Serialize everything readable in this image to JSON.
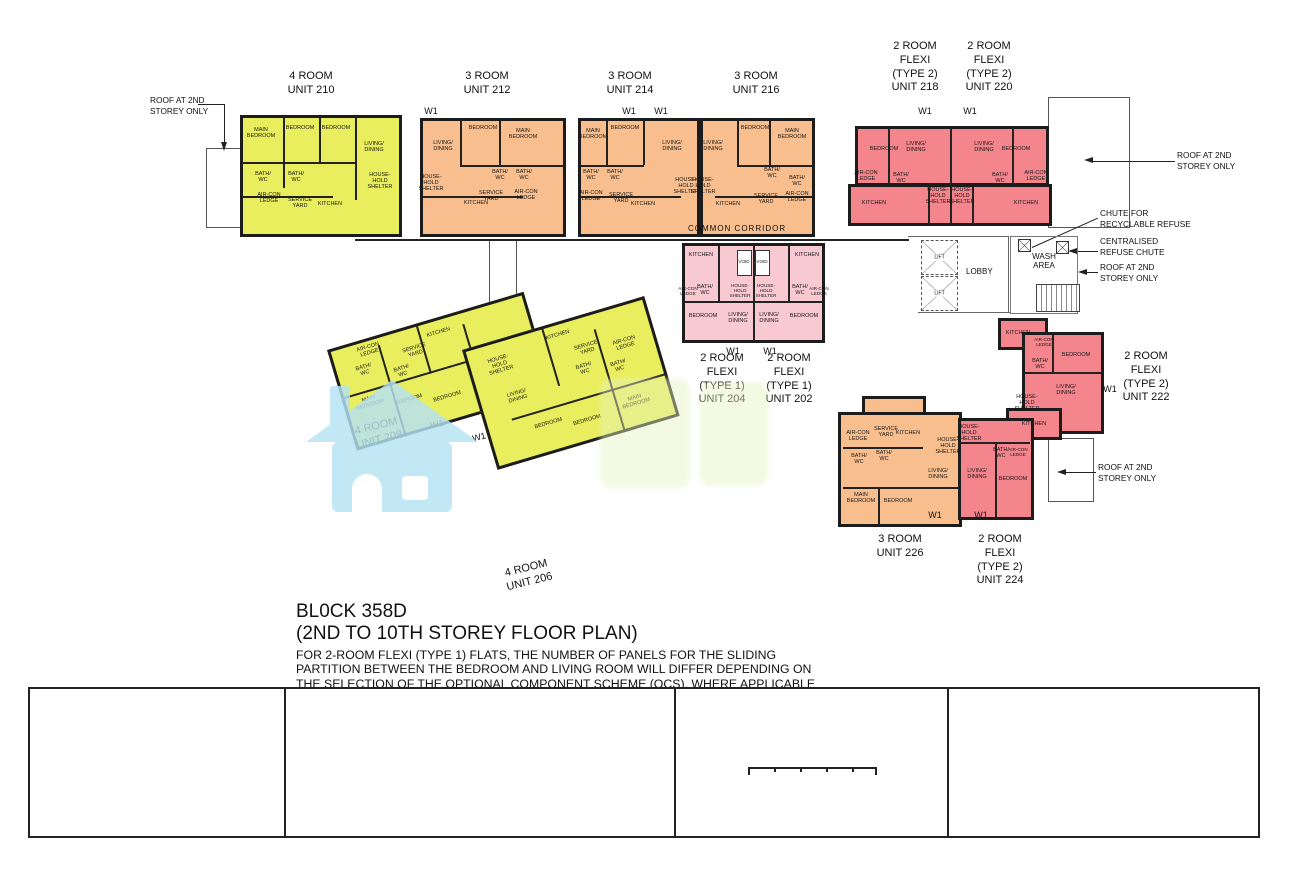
{
  "plan": {
    "w1": "W1",
    "areas": {
      "common_corridor": "COMMON  CORRIDOR",
      "lobby": "LOBBY",
      "wash_area": "WASH\nAREA",
      "lift": "LIFT"
    },
    "annotations": {
      "roof_2nd": "ROOF AT 2ND\nSTOREY ONLY",
      "chute_recyclable": "CHUTE FOR\nRECYCLABLE REFUSE",
      "centralised_chute": "CENTRALISED\nREFUSE CHUTE"
    },
    "units": {
      "u210": {
        "title": "4 ROOM\nUNIT 210",
        "rooms": [
          "MAIN\nBEDROOM",
          "BEDROOM",
          "BEDROOM",
          "LIVING/\nDINING",
          "BATH/\nWC",
          "BATH/\nWC",
          "AIR-CON\nLEDGE",
          "SERVICE\nYARD",
          "KITCHEN",
          "HOUSE-\nHOLD\nSHELTER"
        ]
      },
      "u212": {
        "title": "3 ROOM\nUNIT 212",
        "rooms": [
          "LIVING/\nDINING",
          "BEDROOM",
          "MAIN\nBEDROOM",
          "HOUSE-\nHOLD\nSHELTER",
          "BATH/\nWC",
          "BATH/\nWC",
          "SERVICE\nYARD",
          "AIR-CON\nLEDGE",
          "KITCHEN"
        ]
      },
      "u214": {
        "title": "3 ROOM\nUNIT 214",
        "rooms": [
          "MAIN\nBEDROOM",
          "BEDROOM",
          "LIVING/\nDINING",
          "BATH/\nWC",
          "BATH/\nWC",
          "AIR-CON\nLEDGE",
          "SERVICE\nYARD",
          "KITCHEN",
          "HOUSE-\nHOLD\nSHELTER"
        ]
      },
      "u216": {
        "title": "3 ROOM\nUNIT 216",
        "rooms": [
          "LIVING/\nDINING",
          "BEDROOM",
          "MAIN\nBEDROOM",
          "HOUSE-\nHOLD\nSHELTER",
          "BATH/\nWC",
          "BATH/\nWC",
          "SERVICE\nYARD",
          "AIR-CON\nLEDGE",
          "KITCHEN"
        ]
      },
      "u218": {
        "title": "2 ROOM\nFLEXI\n(TYPE 2)\nUNIT 218",
        "rooms": [
          "BEDROOM",
          "LIVING/\nDINING",
          "BATH/\nWC",
          "AIR-CON\nLEDGE",
          "HOUSE-\nHOLD\nSHELTER",
          "KITCHEN"
        ]
      },
      "u220": {
        "title": "2 ROOM\nFLEXI\n(TYPE 2)\nUNIT 220",
        "rooms": [
          "LIVING/\nDINING",
          "BEDROOM",
          "BATH/\nWC",
          "AIR-CON\nLEDGE",
          "HOUSE-\nHOLD\nSHELTER",
          "KITCHEN"
        ]
      },
      "u204": {
        "title": "2 ROOM\nFLEXI\n(TYPE 1)\nUNIT 204",
        "rooms": [
          "KITCHEN",
          "VOID",
          "BATH/\nWC",
          "AIR-CON\nLEDGE",
          "HOUSE-\nHOLD\nSHELTER",
          "BEDROOM",
          "LIVING/\nDINING"
        ]
      },
      "u202": {
        "title": "2 ROOM\nFLEXI\n(TYPE 1)\nUNIT 202",
        "rooms": [
          "KITCHEN",
          "VOID",
          "BATH/\nWC",
          "AIR-CON\nLEDGE",
          "HOUSE-\nHOLD\nSHELTER",
          "BEDROOM",
          "LIVING/\nDINING"
        ]
      },
      "u222": {
        "title": "2 ROOM\nFLEXI\n(TYPE 2)\nUNIT 222",
        "rooms": [
          "KITCHEN",
          "AIR-CON\nLEDGE",
          "BATH/\nWC",
          "BEDROOM",
          "LIVING/\nDINING",
          "HOUSE-\nHOLD\nSHELTER"
        ]
      },
      "u226": {
        "title": "3 ROOM\nUNIT 226",
        "rooms": [
          "AIR-CON\nLEDGE",
          "SERVICE\nYARD",
          "KITCHEN",
          "BATH/\nWC",
          "BATH/\nWC",
          "LIVING/\nDINING",
          "MAIN\nBEDROOM",
          "BEDROOM",
          "HOUSE-\nHOLD\nSHELTER"
        ]
      },
      "u224": {
        "title": "2 ROOM\nFLEXI\n(TYPE 2)\nUNIT 224",
        "rooms": [
          "KITCHEN",
          "HOUSE-\nHOLD\nSHELTER",
          "BATH/\nWC",
          "AIR-CON\nLEDGE",
          "LIVING/\nDINING",
          "BEDROOM"
        ]
      },
      "u208": {
        "title": "4 ROOM\nUNIT 208",
        "rooms": [
          "AIR-CON\nLEDGE",
          "BATH/\nWC",
          "BATH/\nWC",
          "KITCHEN",
          "SERVICE\nYARD",
          "MAIN\nBEDROOM",
          "BEDROOM",
          "BEDROOM",
          "LIVING/\nDINING"
        ]
      },
      "u206": {
        "title": "4 ROOM\nUNIT 206",
        "rooms": [
          "KITCHEN",
          "HOUSE-\nHOLD\nSHELTER",
          "SERVICE\nYARD",
          "BATH/\nWC",
          "BATH/\nWC",
          "AIR-CON\nLEDGE",
          "LIVING/\nDINING",
          "BEDROOM",
          "BEDROOM",
          "MAIN\nBEDROOM"
        ]
      }
    }
  },
  "title_block": {
    "block": "BL0CK 358D",
    "subtitle": "(2ND TO 10TH STOREY FLOOR PLAN)",
    "note": "FOR 2-ROOM FLEXI (TYPE 1) FLATS, THE NUMBER OF PANELS FOR THE SLIDING\nPARTITION BETWEEN THE BEDROOM AND LIVING ROOM WILL DIFFER DEPENDING ON\nTHE SELECTION OF THE OPTIONAL COMPONENT SCHEME (OCS), WHERE APPLICABLE"
  },
  "legend": {
    "heading": "LEGEND:",
    "items": [
      {
        "label": "2 - Room Flexi ( Type 1 )",
        "color": "#f9c9d2"
      },
      {
        "label": "2 - Room Flexi ( Type 2 )",
        "color": "#f4858d"
      },
      {
        "label": "3 - Room",
        "color": "#f8be8e"
      },
      {
        "label": "4 - Room",
        "color": "#e9ee5e"
      }
    ]
  },
  "window_legend": {
    "heading": "WINDOW LEGEND:",
    "line1": "W1 - THREE QUARTER HEIGHT WINDOW (APPROX. 550mm HIGH PARAPET WALL)",
    "line2": "UNLESS OTHERWISE INDICATED, ALL WINDOWS WILL BE STANDARD HEIGHT WINDOWS"
  },
  "scale_bar": {
    "label": "SCALE",
    "ticks": [
      "0",
      "2",
      "4",
      "6",
      "8",
      "10"
    ],
    "unit": "METRES"
  },
  "disclaimer": "THE COLOURED FLOOR PLAN IS\nNOT INTENDED TO DEMARCATE\nTHE BOUNDARY OF THE FLAT.",
  "colors": {
    "room2_type1": "#f9c9d2",
    "room2_type2": "#f4858d",
    "room3": "#f8be8e",
    "room4": "#e9ee5e",
    "watermark_blue": "#b5e3f5",
    "watermark_green": "#e6f2bf"
  }
}
